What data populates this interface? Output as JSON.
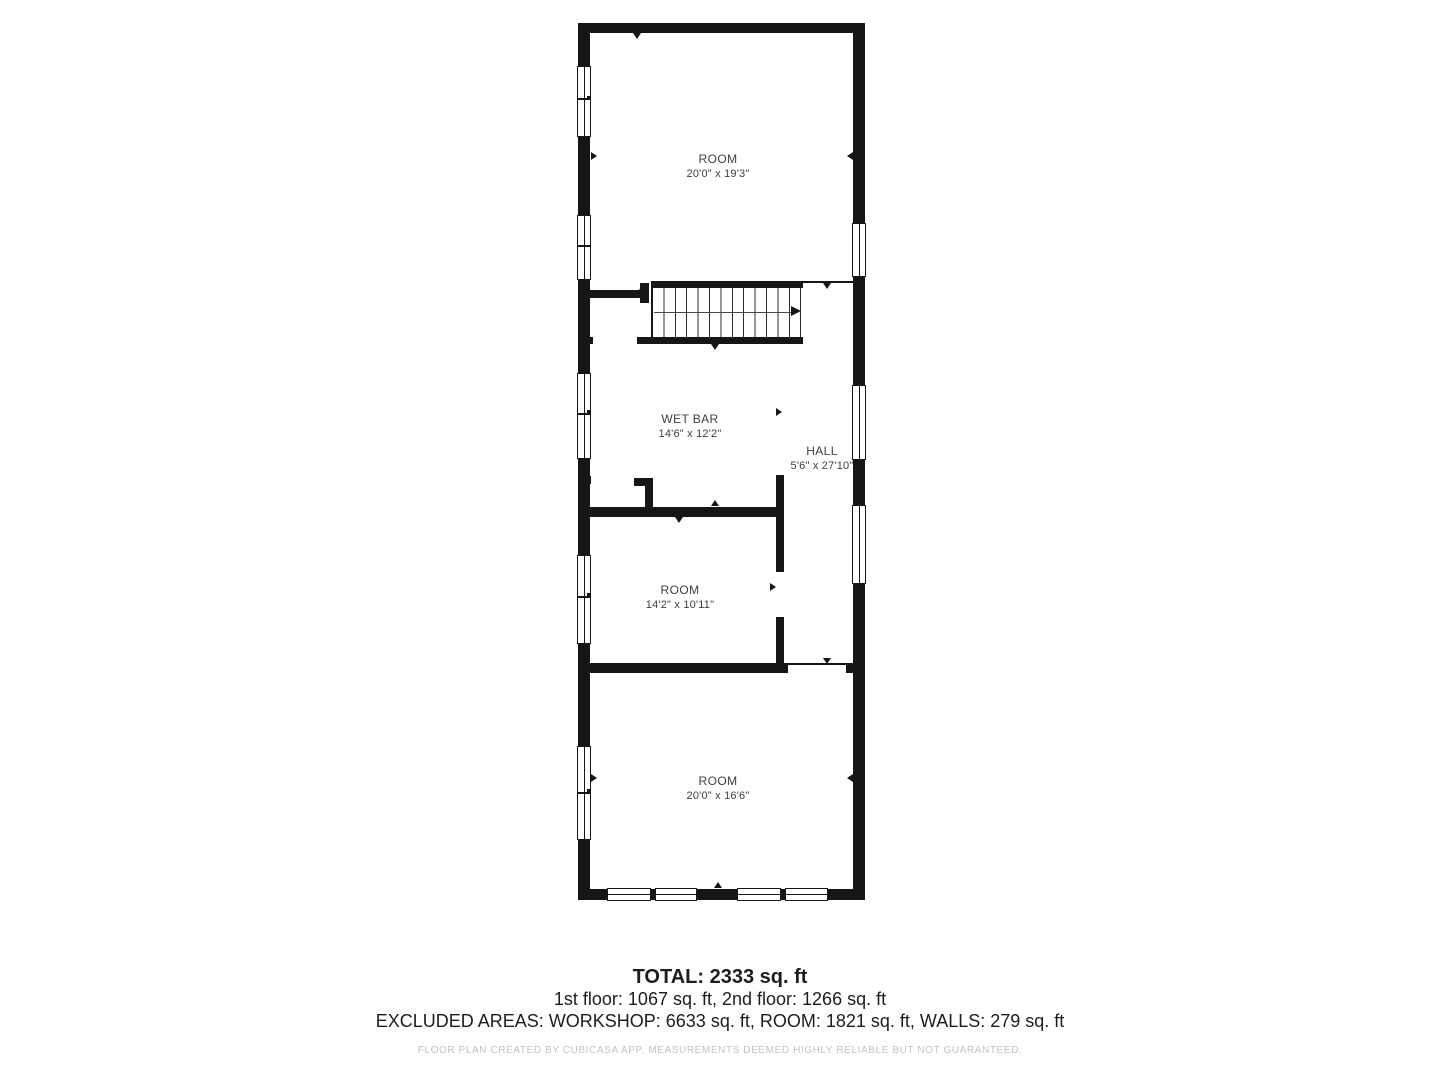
{
  "floor_plan": {
    "rooms": [
      {
        "name": "ROOM",
        "dims": "20'0\" x 19'3\""
      },
      {
        "name": "WET BAR",
        "dims": "14'6\" x 12'2\""
      },
      {
        "name": "HALL",
        "dims": "5'6\" x 27'10\""
      },
      {
        "name": "ROOM",
        "dims": "14'2\" x 10'11\""
      },
      {
        "name": "ROOM",
        "dims": "20'0\" x 16'6\""
      }
    ]
  },
  "summary": {
    "total": "TOTAL: 2333 sq. ft",
    "floors": "1st floor: 1067 sq. ft, 2nd floor: 1266 sq. ft",
    "excluded": "EXCLUDED AREAS: WORKSHOP: 6633 sq. ft, ROOM: 1821 sq. ft, WALLS: 279 sq. ft"
  },
  "footer_note": "FLOOR PLAN CREATED BY CUBICASA APP. MEASUREMENTS DEEMED HIGHLY RELIABLE BUT NOT GUARANTEED.",
  "colors": {
    "wall": "#161616",
    "room_text": "#3e3e3e",
    "summary_text": "#1d1d1d",
    "footer_text": "#c3c3c3"
  }
}
